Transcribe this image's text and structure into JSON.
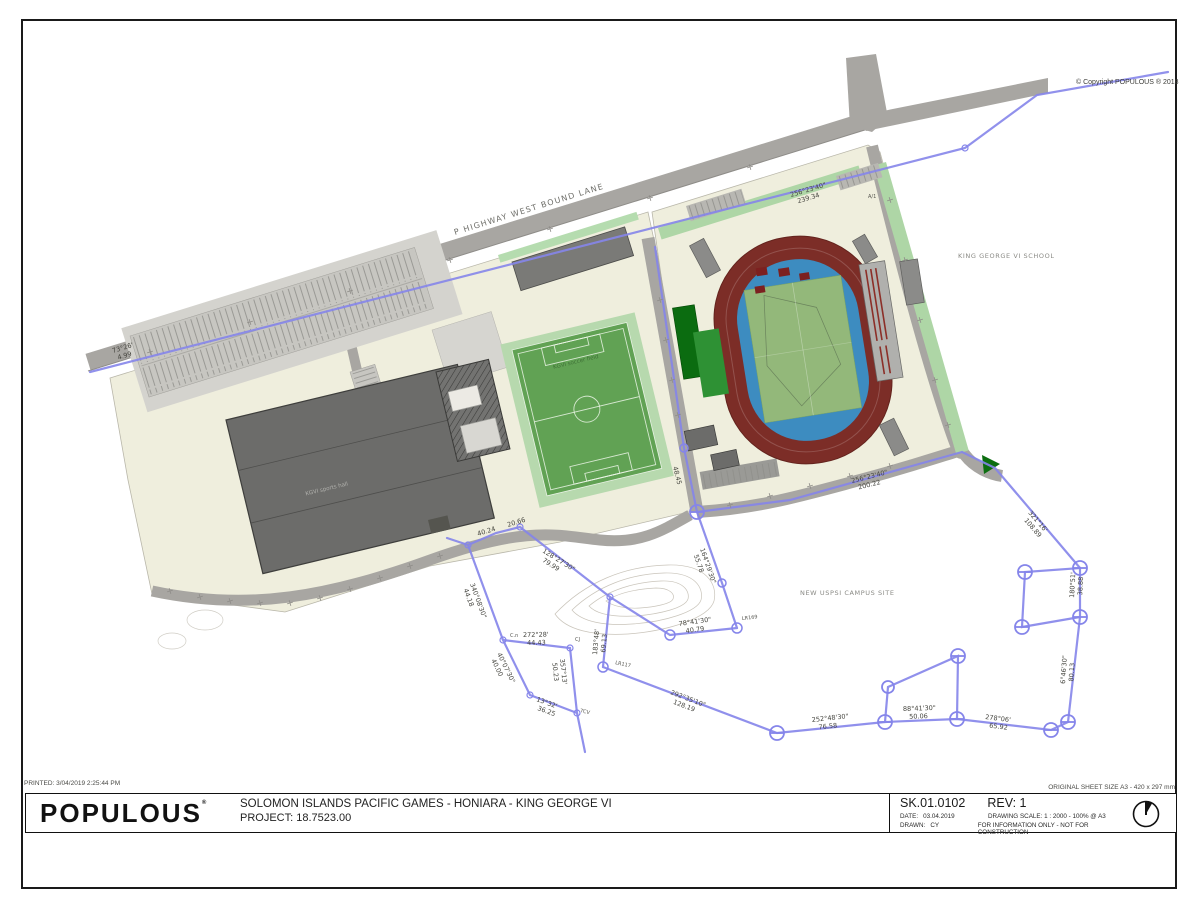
{
  "page": {
    "printed_note": "PRINTED: 3/04/2019 2:25:44 PM",
    "sheet_size_note": "ORIGINAL SHEET SIZE A3 - 420 x 297 mm",
    "copyright": "© Copyright POPULOUS ® 2018"
  },
  "title_block": {
    "logo": "POPULOUS",
    "logo_mark": "®",
    "project_title": "SOLOMON ISLANDS PACIFIC GAMES - HONIARA - KING GEORGE VI",
    "project_number": "PROJECT: 18.7523.00",
    "drawing_number": "SK.01.0102",
    "revision": "REV: 1",
    "date_label": "DATE:",
    "date": "03.04.2019",
    "scale": "DRAWING SCALE: 1 : 2000 - 100% @ A3",
    "drawn_label": "DRAWN:",
    "drawn": "CY",
    "disclaimer": "FOR INFORMATION ONLY - NOT FOR CONSTRUCTION"
  },
  "plan": {
    "labels": {
      "highway": "P HIGHWAY WEST BOUND LANE",
      "school": "KING GEORGE VI SCHOOL",
      "campus": "NEW USPSI CAMPUS SITE",
      "soccer_field": "KGVI soccer field",
      "sports_hall": "KGVI sports hall",
      "a1": "A/1"
    },
    "survey": {
      "markers": {
        "lr117": "LR117",
        "lr169": "LR169",
        "cj": "CJ",
        "cn": "C.n",
        "tcv": "TCV"
      },
      "labels": [
        {
          "bearing": "73°26'",
          "distance": "4.99"
        },
        {
          "bearing": "256°23'40\"",
          "distance": "239.34"
        },
        {
          "bearing": "256°23'40\"",
          "distance": "200.22"
        },
        {
          "bearing": "321°16'",
          "distance": "108.89"
        },
        {
          "bearing": "180°51'",
          "distance": "38.88"
        },
        {
          "bearing": "6°46'30\"",
          "distance": "80.13"
        },
        {
          "bearing": "278°06'",
          "distance": "65.92"
        },
        {
          "bearing": "88°41'30\"",
          "distance": "50.06"
        },
        {
          "bearing": "252°48'30\"",
          "distance": "76.58"
        },
        {
          "bearing": "292°35'10\"",
          "distance": "128.19"
        },
        {
          "bearing": "183°48'",
          "distance": "69.13"
        },
        {
          "bearing": "78°41'30\"",
          "distance": "40.79"
        },
        {
          "bearing": "272°28'",
          "distance": "44.43"
        },
        {
          "bearing": "40°07'30\"",
          "distance": "40.00"
        },
        {
          "bearing": "357°13'",
          "distance": "50.23"
        },
        {
          "bearing": "13°32'",
          "distance": "36.25"
        },
        {
          "bearing": "340°08'30\"",
          "distance": "44.18"
        },
        {
          "bearing": "128°27'30\"",
          "distance": "79.99"
        },
        {
          "bearing": "164°29'30\"",
          "distance": "55.78"
        },
        {
          "bearing": "48.45",
          "distance": ""
        },
        {
          "bearing": "40.24",
          "distance": ""
        },
        {
          "bearing": "20.66",
          "distance": ""
        }
      ]
    },
    "colors": {
      "site_cream": "#efeedd",
      "road_gray": "#a8a6a2",
      "building_gray": "#6c6c6a",
      "landscape_green": "#b5dcaf",
      "field_green": "#61a254",
      "track_maroon": "#7c2d27",
      "stadium_blue": "#3d8cc0",
      "infield_green": "#93b87a",
      "stand_green_dark": "#0b6c10",
      "boundary_purple": "#8585ea"
    }
  }
}
